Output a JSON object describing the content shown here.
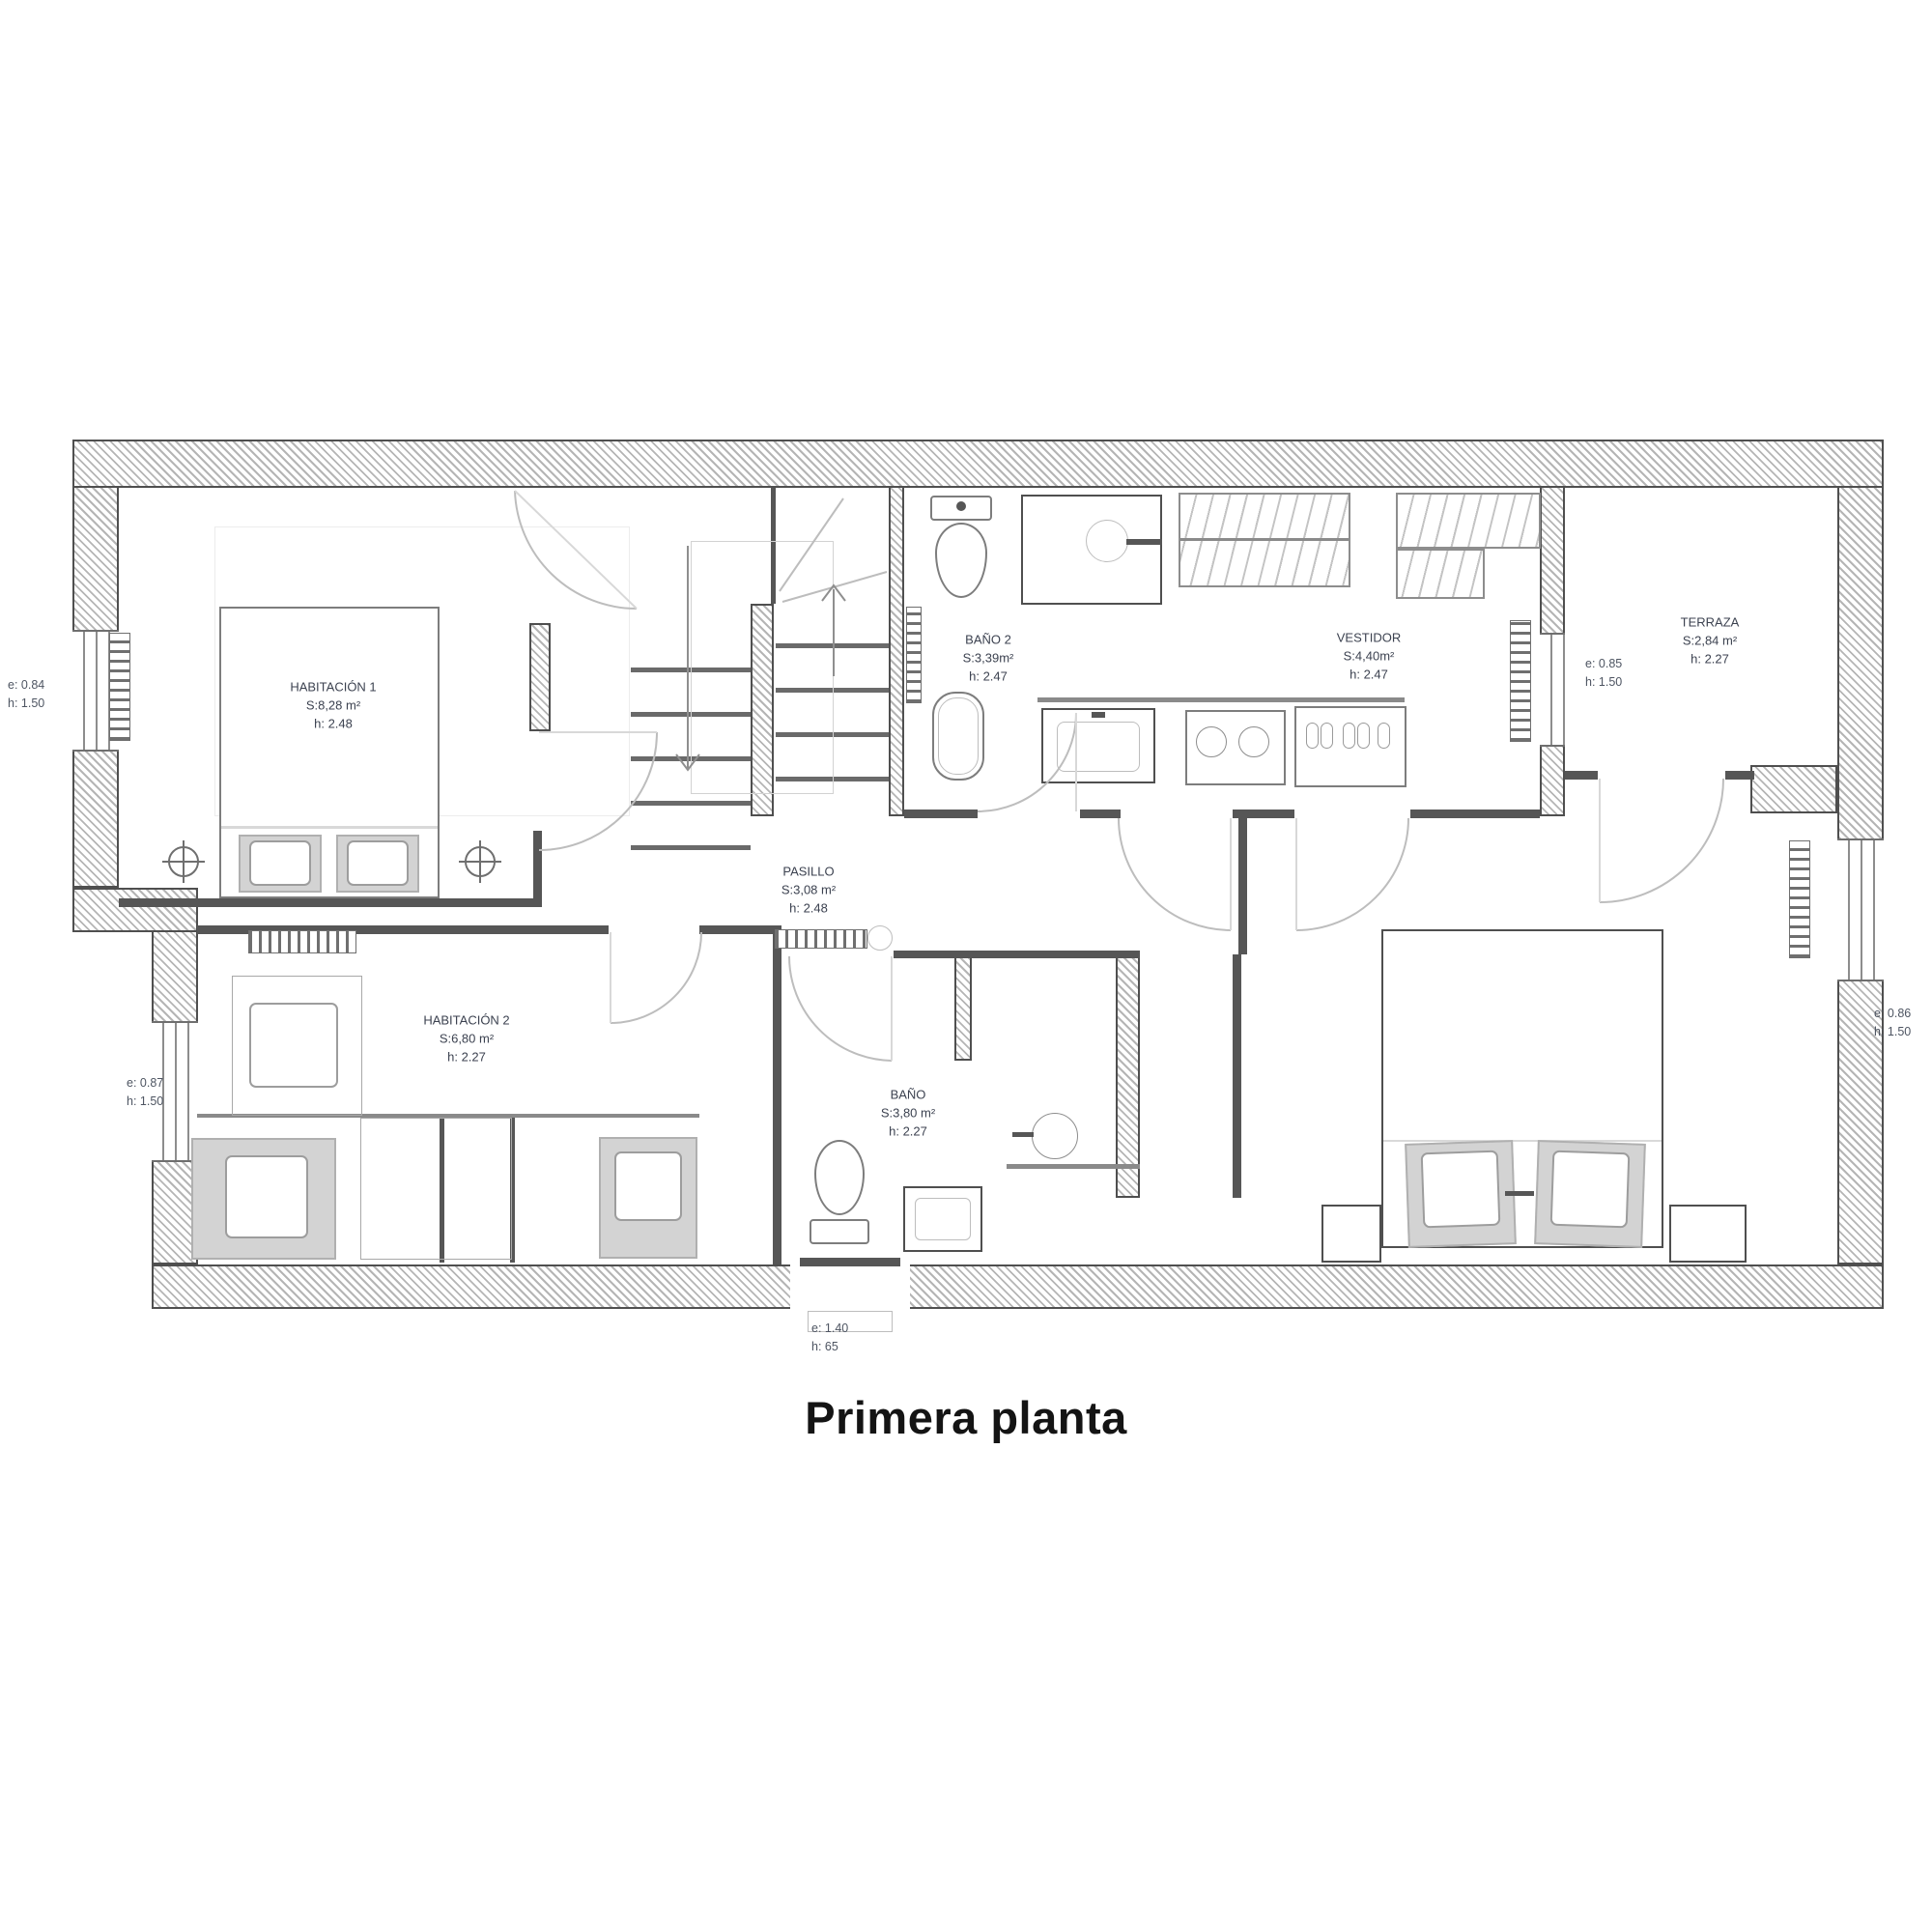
{
  "title": "Primera planta",
  "plan": {
    "floor_color": "#ffffff",
    "wall_color": "#4f4f4f",
    "label_color": "#3c4250",
    "rooms": [
      {
        "id": "habitacion-1",
        "name": "HABITACIÓN 1",
        "area": "S:8,28 m²",
        "height": "h: 2.48"
      },
      {
        "id": "bano-2",
        "name": "BAÑO 2",
        "area": "S:3,39m²",
        "height": "h: 2.47"
      },
      {
        "id": "vestidor",
        "name": "VESTIDOR",
        "area": "S:4,40m²",
        "height": "h: 2.47"
      },
      {
        "id": "terraza",
        "name": "TERRAZA",
        "area": "S:2,84 m²",
        "height": "h: 2.27"
      },
      {
        "id": "pasillo",
        "name": "PASILLO",
        "area": "S:3,08 m²",
        "height": "h: 2.48"
      },
      {
        "id": "habitacion-2",
        "name": "HABITACIÓN 2",
        "area": "S:6,80 m²",
        "height": "h: 2.27"
      },
      {
        "id": "bano",
        "name": "BAÑO",
        "area": "S:3,80 m²",
        "height": "h: 2.27"
      }
    ],
    "openings": [
      {
        "id": "window-left-top",
        "e": "e: 0.84",
        "h": "h: 1.50"
      },
      {
        "id": "window-terraza",
        "e": "e: 0.85",
        "h": "h: 1.50"
      },
      {
        "id": "window-left-bottom",
        "e": "e: 0.87",
        "h": "h: 1.50"
      },
      {
        "id": "window-right",
        "e": "e: 0.86",
        "h": "h: 1.50"
      },
      {
        "id": "window-bottom",
        "e": "e: 1.40",
        "h": "h: 65"
      }
    ]
  }
}
